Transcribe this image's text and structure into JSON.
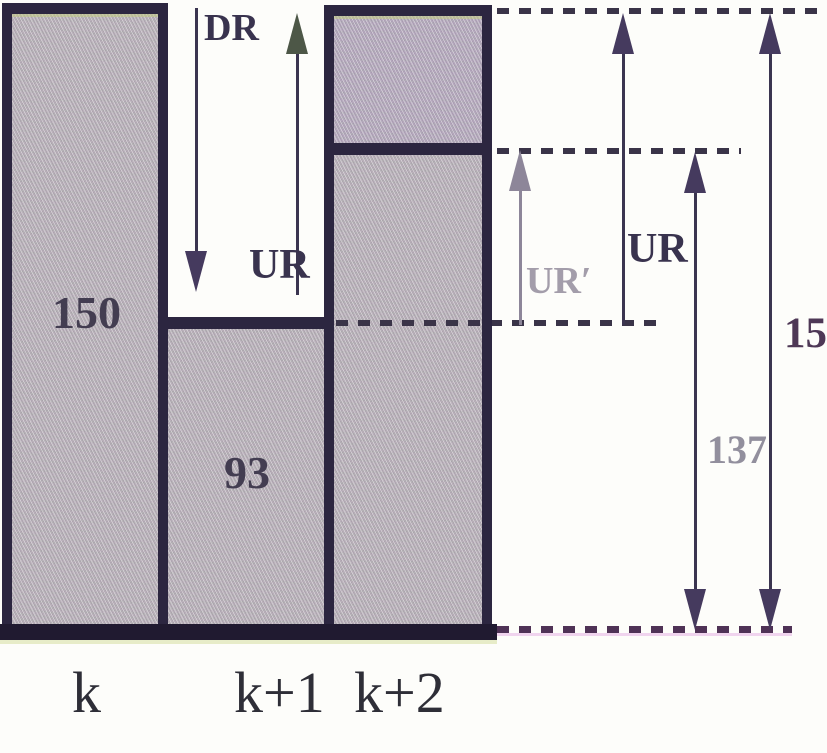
{
  "chart_data": {
    "type": "bar",
    "title": "",
    "xlabel": "",
    "ylabel": "",
    "categories": [
      "k",
      "k+1",
      "k+2"
    ],
    "series": [
      {
        "name": "base-rate",
        "values": [
          150,
          93,
          137
        ]
      },
      {
        "name": "k+2-extension-segment",
        "values": [
          0,
          0,
          13
        ]
      }
    ],
    "bar_value_labels": [
      "150",
      "93",
      null
    ],
    "ylim": [
      0,
      150
    ],
    "grid": false,
    "legend_position": "none",
    "level_dashed_lines": [
      150,
      137,
      93,
      0
    ],
    "gap_annotations": [
      {
        "label": "DR",
        "direction": "down",
        "from_level": 150,
        "to_level": 93,
        "location": "between bar k and bar k+2"
      },
      {
        "label": "UR",
        "direction": "up",
        "from_level": 93,
        "to_level": 150,
        "location": "between bar k and bar k+2"
      }
    ],
    "right_annotations": [
      {
        "label": "UR′",
        "direction": "up",
        "from_level": 93,
        "to_level": 137,
        "style": "gray"
      },
      {
        "label": "UR",
        "direction": "up",
        "from_level": 93,
        "to_level": 150,
        "style": "dark"
      },
      {
        "label": "137",
        "direction": "double",
        "from_level": 0,
        "to_level": 137
      },
      {
        "label": "150",
        "direction": "double",
        "from_level": 0,
        "to_level": 150
      }
    ]
  },
  "labels": {
    "dr": "DR",
    "ur_gap": "UR",
    "ur_prime": "UR′",
    "ur_right": "UR",
    "val_bar_k": "150",
    "val_bar_k1": "93",
    "val_137": "137",
    "val_150_right": "150",
    "cat_k": "k",
    "cat_k1": "k+1",
    "cat_k2": "k+2"
  },
  "colors": {
    "bar_fill": "#b9b2b9",
    "bar_top_section_fill": "#b5aabd",
    "border": "#2c2640",
    "baseline": "#201a30",
    "arrow_dark": "#453a5e",
    "arrow_gray": "#8d8699",
    "ground_dash_tint": "#d787d7",
    "background": "#fdfdfa"
  }
}
